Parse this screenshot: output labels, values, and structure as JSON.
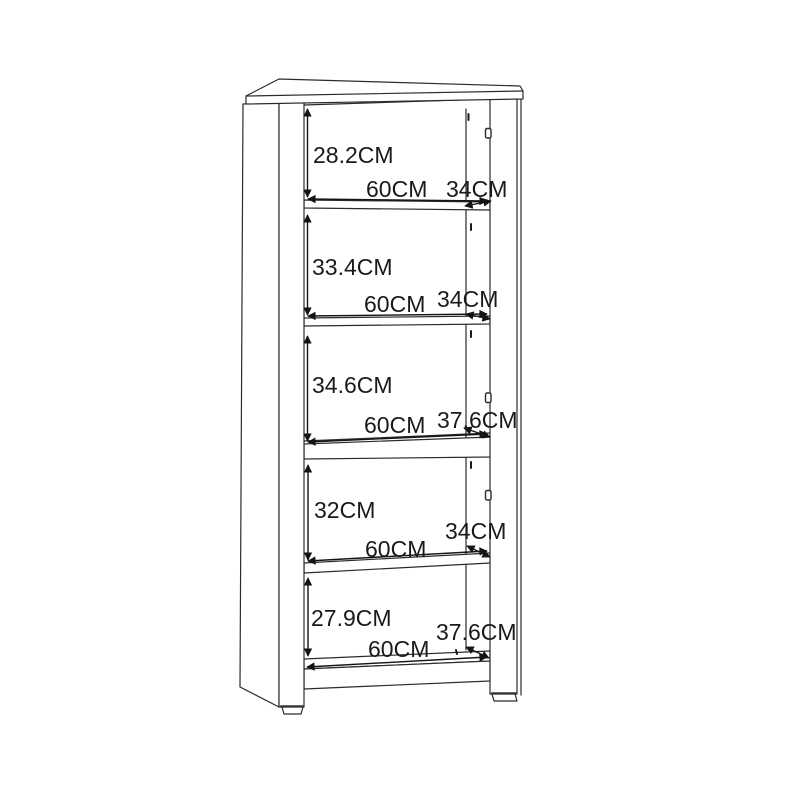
{
  "diagram": {
    "background_color": "#ffffff",
    "line_color": "#2b2b2b",
    "text_color": "#1a1a1a",
    "compartments": [
      {
        "height_label": "28.2CM",
        "width_label": "60CM",
        "depth_label": "34CM"
      },
      {
        "height_label": "33.4CM",
        "width_label": "60CM",
        "depth_label": "34CM"
      },
      {
        "height_label": "34.6CM",
        "width_label": "60CM",
        "depth_label": "37.6CM"
      },
      {
        "height_label": "32CM",
        "width_label": "60CM",
        "depth_label": "34CM"
      },
      {
        "height_label": "27.9CM",
        "width_label": "60CM",
        "depth_label": "37.6CM"
      }
    ]
  }
}
